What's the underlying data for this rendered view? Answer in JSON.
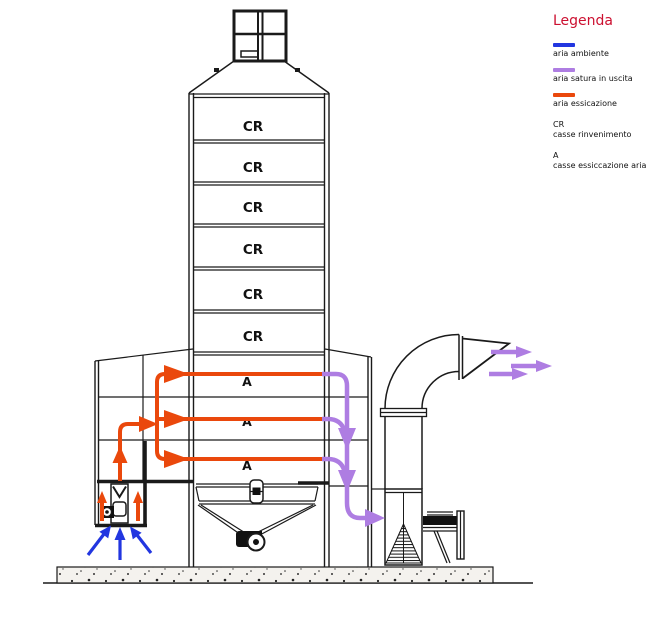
{
  "legend": {
    "title": "Legenda",
    "title_color": "#cc1030",
    "items": [
      {
        "label": "aria ambiente",
        "color": "#2236e0"
      },
      {
        "label": "aria satura in uscita",
        "color": "#ae7de2"
      },
      {
        "label": "aria essicazione",
        "color": "#ea480c"
      }
    ],
    "abbreviations": [
      {
        "code": "CR",
        "label": "casse rinvenimento"
      },
      {
        "code": "A",
        "label": "casse essiccazione aria"
      }
    ]
  },
  "diagram": {
    "cr_labels": [
      "CR",
      "CR",
      "CR",
      "CR",
      "CR",
      "CR"
    ],
    "a_labels": [
      "A",
      "A",
      "A"
    ],
    "colors": {
      "ambient_air": "#2236e0",
      "saturated_air": "#ae7de2",
      "drying_air": "#ea480c",
      "outline": "#1a1a1a"
    }
  }
}
